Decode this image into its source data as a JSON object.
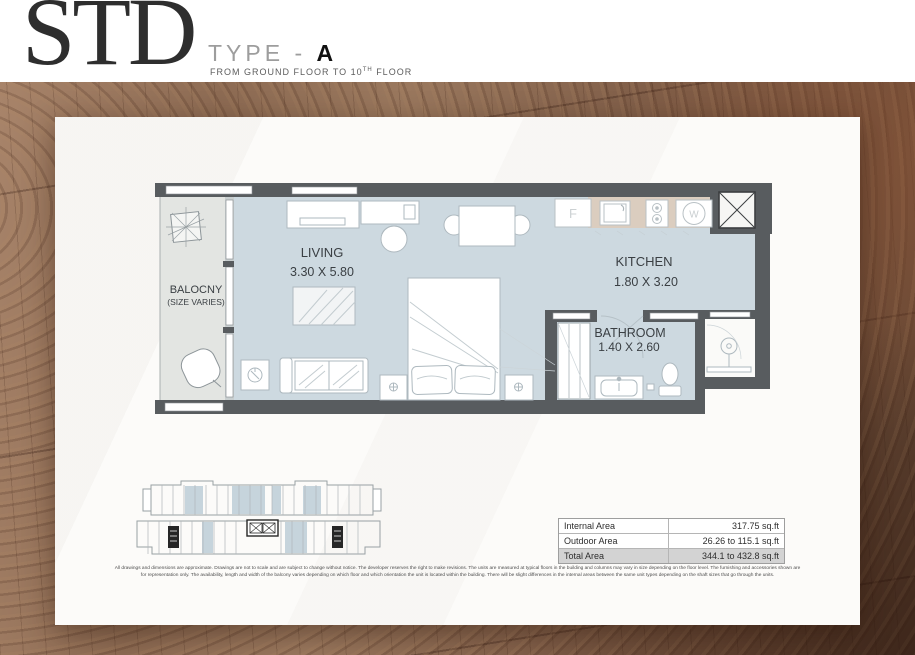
{
  "header": {
    "unit_code": "STD",
    "type_label": "TYPE - ",
    "type_value": "A",
    "floors_prefix": "FROM GROUND FLOOR TO 10",
    "floors_sup": "TH",
    "floors_suffix": " FLOOR"
  },
  "plan": {
    "rooms": {
      "living": {
        "name": "LIVING",
        "dims": "3.30 X 5.80"
      },
      "kitchen": {
        "name": "KITCHEN",
        "dims": "1.80 X 3.20"
      },
      "bathroom": {
        "name": "BATHROOM",
        "dims": "1.40 X 2.60"
      },
      "balcony": {
        "name": "BALOCNY",
        "note": "(SIZE VARIES)"
      }
    },
    "appliances": {
      "fridge": "F",
      "washer": "W"
    }
  },
  "area_table": {
    "rows": [
      {
        "label": "Internal Area",
        "value": "317.75 sq.ft"
      },
      {
        "label": "Outdoor Area",
        "value": "26.26 to 115.1 sq.ft"
      },
      {
        "label": "Total Area",
        "value": "344.1 to 432.8 sq.ft"
      }
    ]
  },
  "disclaimer": {
    "line1": "All drawings and dimensions are approximate. Drawings are not to scale and are subject to change without notice. The developer reserves the right to make revisions. The units are measured at typical floors in the building and columns may vary in size depending on the floor level. The furnishing and accessories shown are",
    "line2": "for representation only. The availability, length and width of the balcony varies depending on which floor and which orientation the unit is located within the building. There will be slight differences in the internal areas between the same unit types depending on the shaft sizes that go through the units."
  },
  "colors": {
    "wall": "#585c5f",
    "floor": "#cdd9e0",
    "balcony_floor": "#e3e5e2",
    "kitchen_counter": "#dbcdbf",
    "keyplan_highlight": "#c6d4dc",
    "table_total_bg": "#d3d3d3",
    "wood_base": "#8d6b53"
  }
}
